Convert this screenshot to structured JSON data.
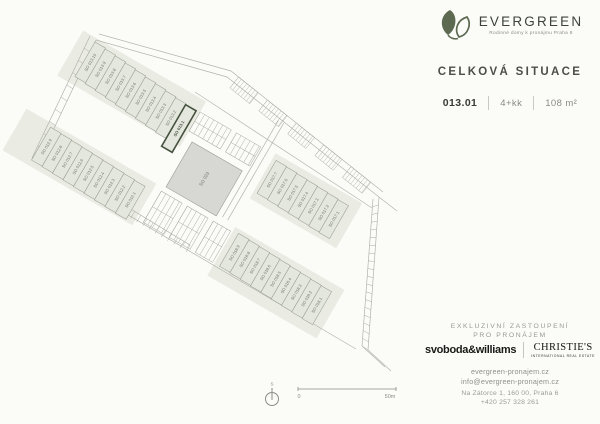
{
  "brand": {
    "name": "EVERGREEN",
    "tagline": "Rodinné domy k pronájmu Praha 8",
    "leaf_color": "#5d6950"
  },
  "heading": {
    "title": "CELKOVÁ SITUACE"
  },
  "unit_info": {
    "id": "013.01",
    "layout": "4+kk",
    "area": "108 m²"
  },
  "plan": {
    "highlight_color": "#46523f",
    "unit_fill": "#e4e7de",
    "unit_stroke": "#9b9e95",
    "ground_fill": "#eaece3",
    "block_fill": "#d7d8d4",
    "line_color": "#b3b5ad",
    "tick_color": "#a9aba2",
    "label_color": "#72756d",
    "central_label": "SO 023",
    "north_label": "S",
    "scale_zero": "0",
    "scale_max": "50m",
    "rows": [
      {
        "name": "SO 013",
        "x": 0,
        "y": 0,
        "w": 12.2,
        "h": 40,
        "stagger": 1.0,
        "highlight": 9,
        "labels": [
          "SO 013.10",
          "SO 013.9",
          "SO 013.8",
          "SO 013.7",
          "SO 013.6",
          "SO 013.5",
          "SO 013.4",
          "SO 013.3",
          "SO 013.2",
          "SO 013.1"
        ]
      },
      {
        "name": "SO 012",
        "x": 4,
        "y": 96,
        "w": 12.4,
        "h": 38,
        "stagger": 0.5,
        "labels": [
          "SO 012.9",
          "SO 012.8",
          "SO 012.7",
          "SO 012.6",
          "SO 012.5",
          "SO 012.4",
          "SO 012.3",
          "SO 012.2",
          "SO 012.1"
        ]
      },
      {
        "name": "SO 017",
        "x": 216,
        "y": 12,
        "w": 12.2,
        "h": 38,
        "stagger": 0.5,
        "labels": [
          "SO 017.7",
          "SO 017.6",
          "SO 017.5",
          "SO 017.4",
          "SO 017.3",
          "SO 017.2",
          "SO 017.1"
        ]
      },
      {
        "name": "SO 018",
        "x": 220,
        "y": 94,
        "w": 12.2,
        "h": 38,
        "stagger": 0.5,
        "labels": [
          "SO 018.9",
          "SO 018.8",
          "SO 018.7",
          "SO 018.6",
          "SO 018.5",
          "SO 018.4",
          "SO 018.3",
          "SO 018.2",
          "SO 018.1"
        ]
      }
    ]
  },
  "agency": {
    "exclusivity_line1": "EXKLUZIVNÍ ZASTOUPENÍ",
    "exclusivity_line2": "PRO PRONÁJEM",
    "broker1": "svoboda&williams",
    "broker2": "CHRISTIE'S",
    "broker2_sub": "INTERNATIONAL REAL ESTATE",
    "web": "evergreen-pronajem.cz",
    "email": "info@evergreen-pronajem.cz",
    "address": "Na Zátorce 1, 160 00, Praha 6",
    "phone": "+420 257 328 261"
  }
}
